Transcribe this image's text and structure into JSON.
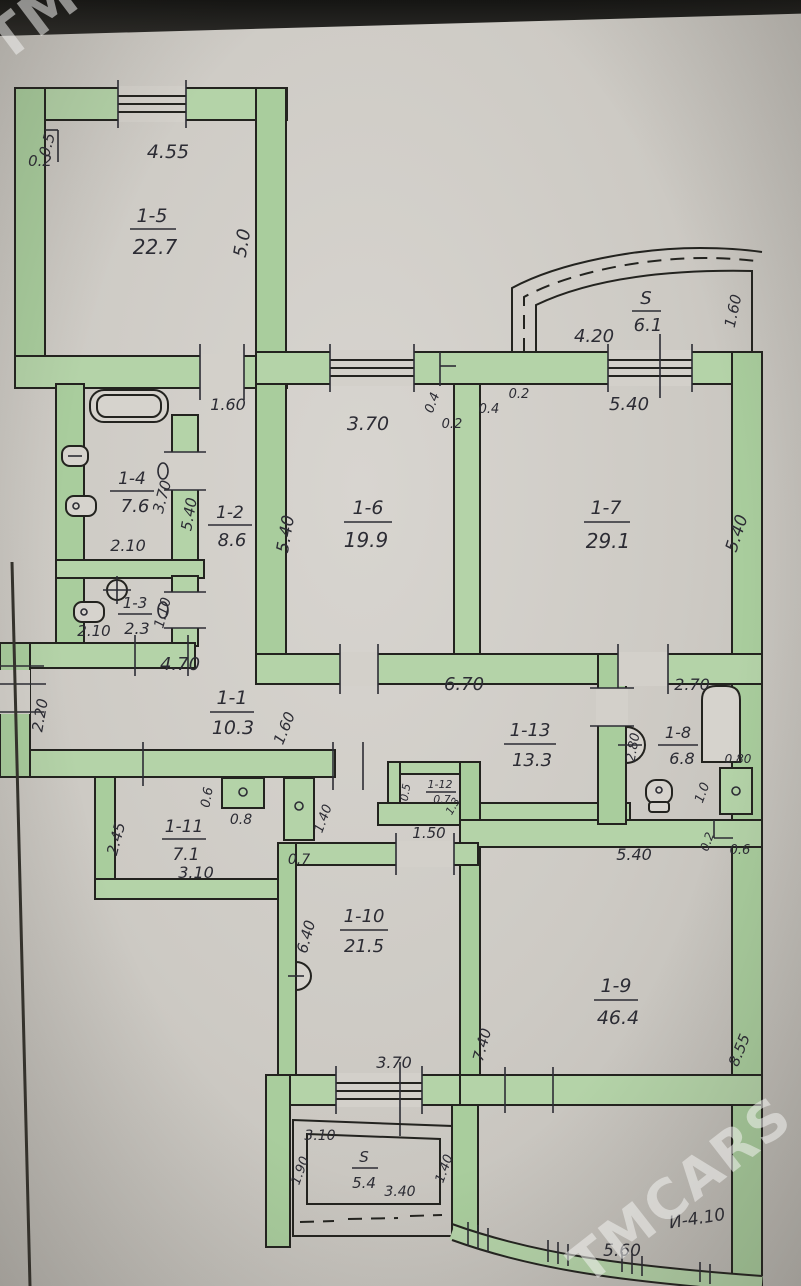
{
  "watermark": {
    "text": "TMCARS"
  },
  "rooms": {
    "r15": {
      "id": "1-5",
      "area": "22.7"
    },
    "balct": {
      "id": "S",
      "area": "6.1"
    },
    "r16": {
      "id": "1-6",
      "area": "19.9"
    },
    "r17": {
      "id": "1-7",
      "area": "29.1"
    },
    "r14": {
      "id": "1-4",
      "area": "7.6"
    },
    "r12": {
      "id": "1-2",
      "area": "8.6"
    },
    "r13": {
      "id": "1-3",
      "area": "2.3"
    },
    "r11": {
      "id": "1-1",
      "area": "10.3"
    },
    "r113": {
      "id": "1-13",
      "area": "13.3"
    },
    "r18": {
      "id": "1-8",
      "area": "6.8"
    },
    "r112": {
      "id": "1-12",
      "area": "0.7"
    },
    "r111": {
      "id": "1-11",
      "area": "7.1"
    },
    "r110": {
      "id": "1-10",
      "area": "21.5"
    },
    "r19": {
      "id": "1-9",
      "area": "46.4"
    },
    "balcb": {
      "id": "S",
      "area": "5.4"
    }
  },
  "dims": {
    "b455": "4.55",
    "b02": "0.2",
    "b05": "0.5",
    "b50": "5.0",
    "t420": "4.20",
    "t160": "1.60",
    "r160door": "1.60",
    "r370top": "3.70",
    "r04a": "0.4",
    "r02a": "0.2",
    "r04b": "0.4",
    "r02b": "0.2",
    "r540t": "5.40",
    "r540l": "5.40",
    "r540r": "5.40",
    "r540h": "5.40",
    "r370v": "3.70",
    "r210a": "2.10",
    "r210b": "2.10",
    "r110": "1.10",
    "c470": "4.70",
    "c220": "2.20",
    "c160": "1.60",
    "c670": "6.70",
    "e270": "2.70",
    "e280": "2.80",
    "e080": "0.80",
    "e10": "1.0",
    "e540": "5.40",
    "e02": "0.2",
    "e06": "0.6",
    "k05": "0.5",
    "k13": "1.3",
    "k150": "1.50",
    "f06": "0.6",
    "f08": "0.8",
    "f140": "1.40",
    "f07": "0.7",
    "g245": "2.45",
    "g310": "3.10",
    "h640": "6.40",
    "h370": "3.70",
    "h740": "7.40",
    "h855": "8.55",
    "m310": "3.10",
    "m340": "3.40",
    "m190": "1.90",
    "m140": "1.40",
    "z560": "5.60",
    "z410": "И-4.10"
  }
}
